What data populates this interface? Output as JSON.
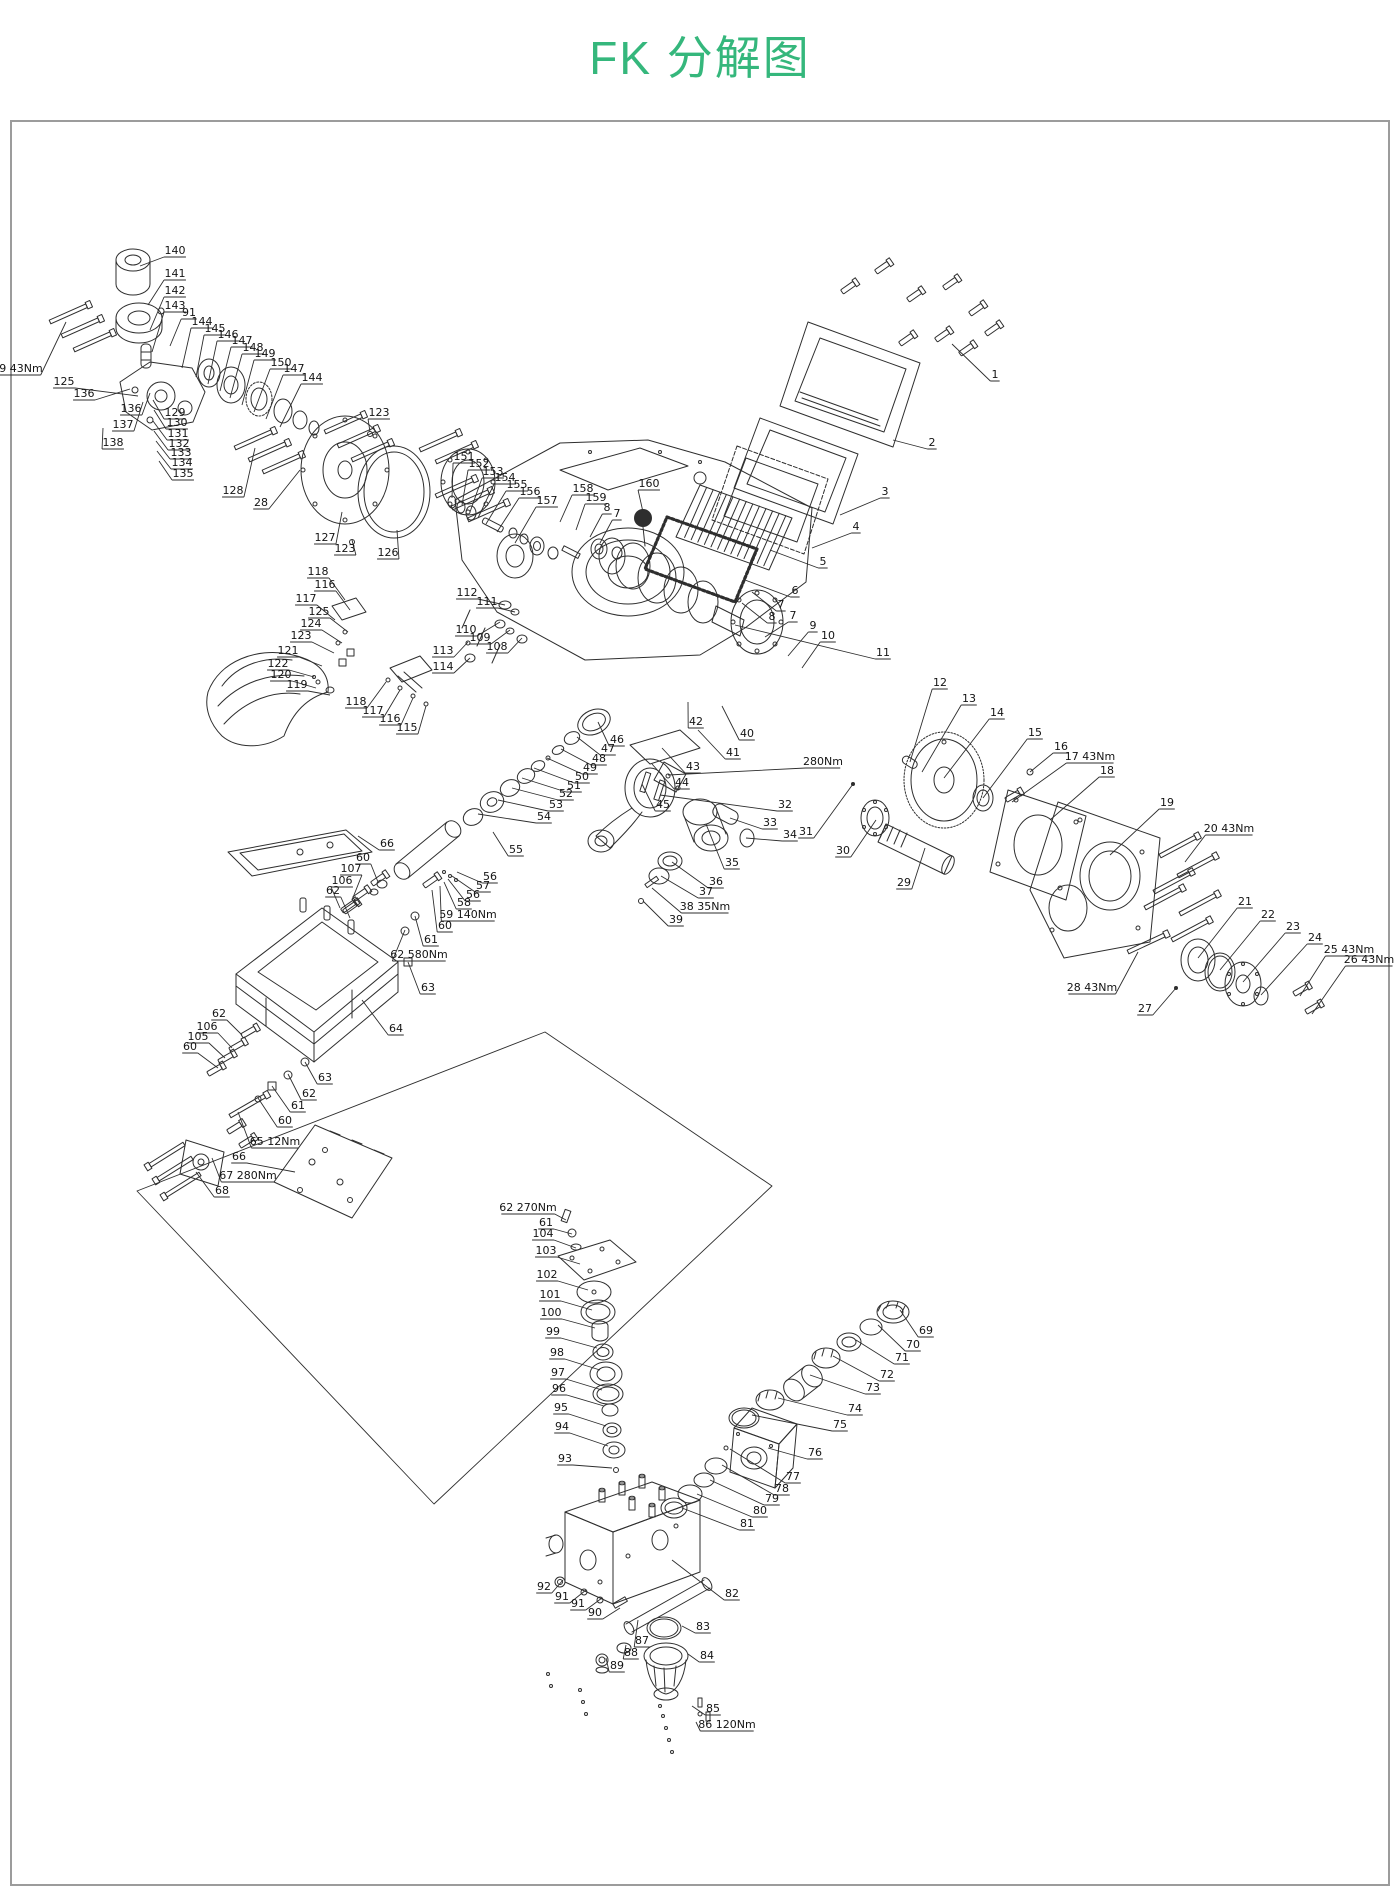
{
  "title": "FK 分解图",
  "title_color": "#35b77c",
  "frame_border_color": "#9c9c9c",
  "art_line_color": "#2e2e2e",
  "labels": [
    [
      "140",
      175,
      251,
      140,
      266
    ],
    [
      "141",
      175,
      274,
      148,
      305
    ],
    [
      "142",
      175,
      291,
      150,
      330
    ],
    [
      "143",
      175,
      306,
      152,
      352
    ],
    [
      "91",
      189,
      313,
      170,
      346
    ],
    [
      "144",
      202,
      322,
      182,
      368
    ],
    [
      "145",
      215,
      329,
      196,
      377
    ],
    [
      "146",
      228,
      335,
      208,
      384
    ],
    [
      "147",
      242,
      341,
      220,
      391
    ],
    [
      "148",
      253,
      348,
      230,
      398
    ],
    [
      "149",
      265,
      354,
      242,
      405
    ],
    [
      "150",
      281,
      363,
      254,
      412
    ],
    [
      "147",
      294,
      369,
      266,
      419
    ],
    [
      "144",
      312,
      378,
      280,
      427
    ],
    [
      "139 43Nm",
      14,
      369,
      66,
      322
    ],
    [
      "125",
      64,
      382,
      138,
      396
    ],
    [
      "136",
      84,
      394,
      130,
      389
    ],
    [
      "136",
      131,
      409,
      150,
      393
    ],
    [
      "137",
      123,
      425,
      143,
      402
    ],
    [
      "138",
      113,
      443,
      103,
      428
    ],
    [
      "129",
      175,
      413,
      153,
      400
    ],
    [
      "130",
      177,
      423,
      154,
      410
    ],
    [
      "131",
      178,
      434,
      153,
      421
    ],
    [
      "132",
      179,
      444,
      154,
      431
    ],
    [
      "133",
      181,
      453,
      156,
      441
    ],
    [
      "134",
      182,
      463,
      157,
      451
    ],
    [
      "135",
      183,
      474,
      159,
      461
    ],
    [
      "128",
      233,
      491,
      255,
      448
    ],
    [
      "28",
      261,
      503,
      300,
      470
    ],
    [
      "127",
      325,
      538,
      342,
      512
    ],
    [
      "123",
      345,
      549,
      352,
      540
    ],
    [
      "126",
      388,
      553,
      397,
      530
    ],
    [
      "123",
      379,
      413,
      370,
      432
    ],
    [
      "151",
      464,
      457,
      452,
      498
    ],
    [
      "152",
      479,
      464,
      462,
      505
    ],
    [
      "153",
      493,
      472,
      470,
      512
    ],
    [
      "154",
      505,
      478,
      478,
      518
    ],
    [
      "155",
      517,
      485,
      486,
      524
    ],
    [
      "156",
      530,
      492,
      497,
      532
    ],
    [
      "157",
      547,
      501,
      515,
      543
    ],
    [
      "158",
      583,
      489,
      560,
      522
    ],
    [
      "159",
      596,
      498,
      576,
      530
    ],
    [
      "8",
      607,
      508,
      590,
      537
    ],
    [
      "7",
      617,
      514,
      600,
      543
    ],
    [
      "160",
      649,
      484,
      643,
      512
    ],
    [
      "1",
      995,
      375,
      952,
      344
    ],
    [
      "2",
      932,
      443,
      893,
      440
    ],
    [
      "3",
      885,
      492,
      840,
      515
    ],
    [
      "4",
      856,
      527,
      812,
      548
    ],
    [
      "5",
      823,
      562,
      770,
      550
    ],
    [
      "6",
      795,
      591,
      745,
      580
    ],
    [
      "7",
      781,
      605,
      752,
      592
    ],
    [
      "8",
      772,
      617,
      742,
      603
    ],
    [
      "7",
      793,
      616,
      765,
      637
    ],
    [
      "9",
      813,
      626,
      788,
      656
    ],
    [
      "10",
      828,
      636,
      802,
      668
    ],
    [
      "11",
      883,
      653,
      735,
      625
    ],
    [
      "12",
      940,
      683,
      910,
      762
    ],
    [
      "13",
      969,
      699,
      922,
      772
    ],
    [
      "14",
      997,
      713,
      944,
      778
    ],
    [
      "15",
      1035,
      733,
      983,
      798
    ],
    [
      "16",
      1061,
      747,
      1030,
      772
    ],
    [
      "17 43Nm",
      1090,
      757,
      1012,
      802
    ],
    [
      "18",
      1107,
      771,
      1050,
      820
    ],
    [
      "19",
      1167,
      803,
      1110,
      855
    ],
    [
      "20 43Nm",
      1229,
      829,
      1185,
      862
    ],
    [
      "21",
      1245,
      902,
      1198,
      958
    ],
    [
      "22",
      1268,
      915,
      1220,
      970
    ],
    [
      "23",
      1293,
      927,
      1243,
      982
    ],
    [
      "24",
      1315,
      938,
      1261,
      995
    ],
    [
      "25 43Nm",
      1349,
      950,
      1300,
      996
    ],
    [
      "26 43Nm",
      1369,
      960,
      1312,
      1014
    ],
    [
      "28 43Nm",
      1092,
      988,
      1138,
      952
    ],
    [
      "27",
      1145,
      1009,
      1176,
      988
    ],
    [
      "280Nm",
      823,
      762,
      668,
      775
    ],
    [
      "32",
      785,
      805,
      660,
      795
    ],
    [
      "33",
      770,
      823,
      730,
      818
    ],
    [
      "34",
      790,
      835,
      746,
      838
    ],
    [
      "31",
      806,
      832,
      853,
      784
    ],
    [
      "30",
      843,
      851,
      876,
      820
    ],
    [
      "29",
      904,
      883,
      925,
      848
    ],
    [
      "35",
      732,
      863,
      706,
      824
    ],
    [
      "36",
      716,
      882,
      672,
      862
    ],
    [
      "37",
      706,
      892,
      661,
      876
    ],
    [
      "38 35Nm",
      705,
      907,
      652,
      888
    ],
    [
      "39",
      676,
      920,
      643,
      901
    ],
    [
      "40",
      747,
      734,
      722,
      706
    ],
    [
      "41",
      733,
      753,
      698,
      730
    ],
    [
      "42",
      696,
      722,
      688,
      702
    ],
    [
      "43",
      693,
      767,
      662,
      748
    ],
    [
      "44",
      682,
      783,
      652,
      764
    ],
    [
      "45",
      663,
      805,
      642,
      784
    ],
    [
      "46",
      617,
      740,
      598,
      722
    ],
    [
      "47",
      608,
      749,
      577,
      737
    ],
    [
      "48",
      599,
      759,
      561,
      749
    ],
    [
      "49",
      590,
      768,
      547,
      758
    ],
    [
      "50",
      582,
      777,
      534,
      768
    ],
    [
      "51",
      574,
      786,
      522,
      778
    ],
    [
      "52",
      566,
      794,
      512,
      788
    ],
    [
      "53",
      556,
      805,
      498,
      800
    ],
    [
      "54",
      544,
      817,
      478,
      814
    ],
    [
      "55",
      516,
      850,
      493,
      832
    ],
    [
      "56",
      490,
      877,
      457,
      872
    ],
    [
      "57",
      483,
      886,
      452,
      876
    ],
    [
      "56",
      473,
      895,
      448,
      879
    ],
    [
      "58",
      464,
      903,
      444,
      882
    ],
    [
      "59 140Nm",
      468,
      915,
      440,
      886
    ],
    [
      "60",
      445,
      926,
      432,
      890
    ],
    [
      "112",
      467,
      593,
      505,
      605
    ],
    [
      "111",
      487,
      602,
      515,
      612
    ],
    [
      "110",
      466,
      630,
      500,
      622
    ],
    [
      "109",
      480,
      638,
      510,
      630
    ],
    [
      "108",
      497,
      647,
      522,
      638
    ],
    [
      "113",
      443,
      651,
      468,
      642
    ],
    [
      "114",
      443,
      667,
      470,
      658
    ],
    [
      "118",
      318,
      572,
      345,
      600
    ],
    [
      "116",
      325,
      585,
      350,
      610
    ],
    [
      "117",
      306,
      599,
      335,
      620
    ],
    [
      "125",
      319,
      612,
      348,
      632
    ],
    [
      "124",
      311,
      624,
      342,
      643
    ],
    [
      "123",
      301,
      636,
      334,
      653
    ],
    [
      "121",
      288,
      651,
      322,
      666
    ],
    [
      "122",
      278,
      664,
      314,
      677
    ],
    [
      "120",
      281,
      675,
      316,
      688
    ],
    [
      "119",
      297,
      685,
      330,
      695
    ],
    [
      "118",
      356,
      702,
      386,
      682
    ],
    [
      "117",
      373,
      711,
      400,
      690
    ],
    [
      "116",
      390,
      719,
      413,
      698
    ],
    [
      "115",
      407,
      728,
      426,
      706
    ],
    [
      "66",
      387,
      844,
      358,
      836
    ],
    [
      "60",
      363,
      858,
      378,
      882
    ],
    [
      "107",
      351,
      869,
      352,
      900
    ],
    [
      "106",
      342,
      881,
      340,
      908
    ],
    [
      "62",
      333,
      891,
      350,
      918
    ],
    [
      "61",
      431,
      940,
      415,
      916
    ],
    [
      "62 580Nm",
      419,
      955,
      405,
      930
    ],
    [
      "63",
      428,
      988,
      408,
      962
    ],
    [
      "64",
      396,
      1029,
      362,
      1000
    ],
    [
      "62",
      219,
      1014,
      242,
      1035
    ],
    [
      "106",
      207,
      1027,
      232,
      1048
    ],
    [
      "105",
      198,
      1037,
      225,
      1058
    ],
    [
      "60",
      190,
      1047,
      218,
      1068
    ],
    [
      "63",
      325,
      1078,
      305,
      1062
    ],
    [
      "62",
      309,
      1094,
      288,
      1074
    ],
    [
      "61",
      298,
      1106,
      272,
      1086
    ],
    [
      "60",
      285,
      1121,
      258,
      1098
    ],
    [
      "65 12Nm",
      275,
      1142,
      238,
      1112
    ],
    [
      "66",
      239,
      1157,
      295,
      1172
    ],
    [
      "67 280Nm",
      248,
      1176,
      212,
      1158
    ],
    [
      "68",
      222,
      1191,
      196,
      1172
    ],
    [
      "62 270Nm",
      528,
      1208,
      566,
      1220
    ],
    [
      "61",
      546,
      1223,
      572,
      1234
    ],
    [
      "104",
      543,
      1234,
      576,
      1248
    ],
    [
      "103",
      546,
      1251,
      580,
      1264
    ],
    [
      "102",
      547,
      1275,
      588,
      1290
    ],
    [
      "101",
      550,
      1295,
      592,
      1310
    ],
    [
      "100",
      551,
      1313,
      595,
      1328
    ],
    [
      "99",
      553,
      1332,
      597,
      1348
    ],
    [
      "98",
      557,
      1353,
      600,
      1370
    ],
    [
      "97",
      558,
      1373,
      602,
      1390
    ],
    [
      "96",
      559,
      1389,
      604,
      1406
    ],
    [
      "95",
      561,
      1408,
      606,
      1426
    ],
    [
      "94",
      562,
      1427,
      608,
      1446
    ],
    [
      "93",
      565,
      1459,
      612,
      1468
    ],
    [
      "69",
      926,
      1331,
      900,
      1310
    ],
    [
      "70",
      913,
      1345,
      878,
      1325
    ],
    [
      "71",
      902,
      1358,
      856,
      1340
    ],
    [
      "72",
      887,
      1375,
      833,
      1356
    ],
    [
      "73",
      873,
      1388,
      810,
      1375
    ],
    [
      "74",
      855,
      1409,
      778,
      1398
    ],
    [
      "75",
      840,
      1425,
      752,
      1415
    ],
    [
      "76",
      815,
      1453,
      768,
      1448
    ],
    [
      "77",
      793,
      1477,
      730,
      1449
    ],
    [
      "78",
      782,
      1489,
      722,
      1465
    ],
    [
      "79",
      772,
      1499,
      710,
      1480
    ],
    [
      "80",
      760,
      1511,
      697,
      1494
    ],
    [
      "81",
      747,
      1524,
      682,
      1508
    ],
    [
      "82",
      732,
      1594,
      672,
      1560
    ],
    [
      "92",
      544,
      1587,
      563,
      1580
    ],
    [
      "91",
      562,
      1597,
      586,
      1590
    ],
    [
      "91",
      578,
      1604,
      602,
      1598
    ],
    [
      "90",
      595,
      1613,
      620,
      1608
    ],
    [
      "87",
      642,
      1641,
      638,
      1620
    ],
    [
      "88",
      631,
      1653,
      626,
      1645
    ],
    [
      "89",
      617,
      1666,
      606,
      1658
    ],
    [
      "83",
      703,
      1627,
      682,
      1626
    ],
    [
      "84",
      707,
      1656,
      688,
      1654
    ],
    [
      "85",
      713,
      1709,
      692,
      1706
    ],
    [
      "86 120Nm",
      727,
      1725,
      696,
      1722
    ]
  ]
}
